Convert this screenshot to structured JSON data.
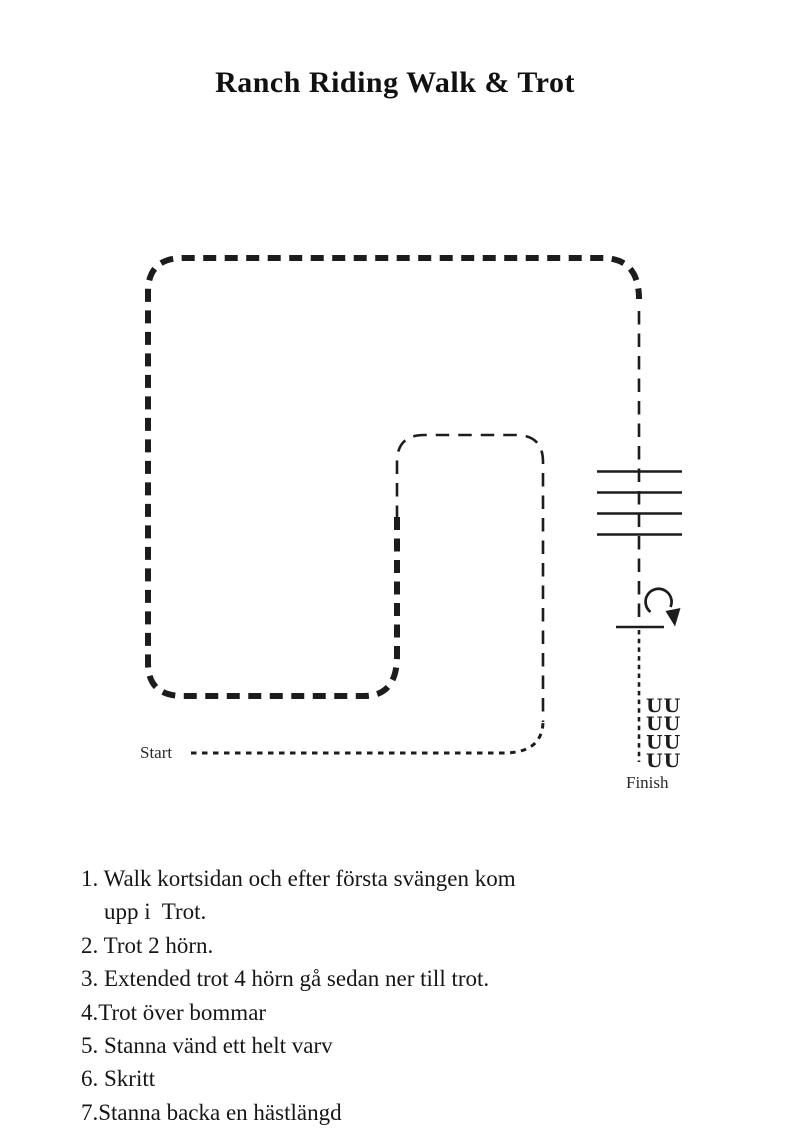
{
  "page": {
    "background": "#ffffff",
    "ink": "#1c1c1c"
  },
  "title": "Ranch Riding Walk & Trot",
  "diagram": {
    "start_label": "Start",
    "finish_label": "Finish",
    "back_marks": [
      "UU",
      "UU",
      "UU",
      "UU"
    ],
    "poles_count": 4
  },
  "instructions": [
    "1. Walk kortsidan och efter första svängen kom\n    upp i  Trot.",
    "2. Trot 2 hörn.",
    "3. Extended trot 4 hörn gå sedan ner till trot.",
    "4.Trot över bommar",
    "5. Stanna vänd ett helt varv",
    "6. Skritt",
    "7.Stanna backa en hästlängd"
  ]
}
